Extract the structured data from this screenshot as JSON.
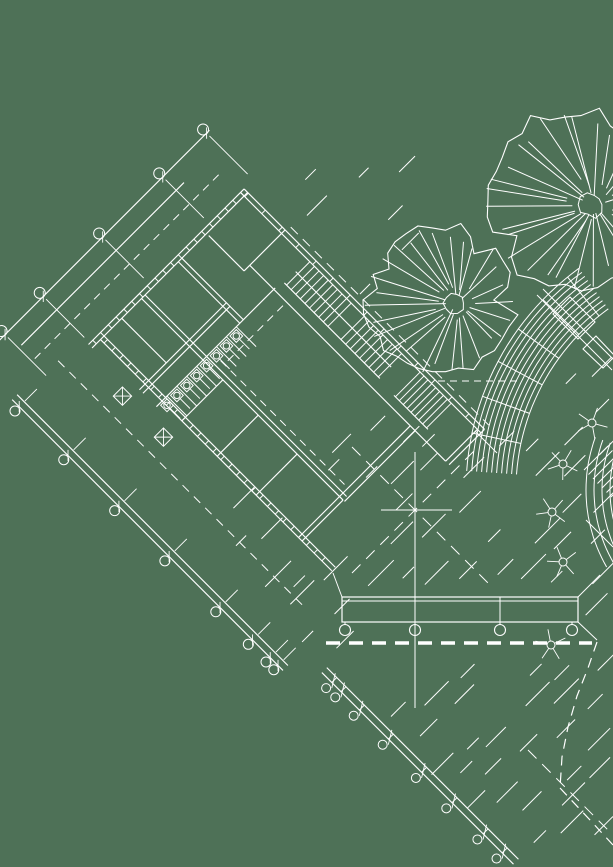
{
  "canvas": {
    "width": 613,
    "height": 867,
    "background": "#4e7157",
    "line_color": "#ffffff"
  },
  "drawing": {
    "building": {
      "origin": [
        97,
        336
      ],
      "rotation_deg": -45,
      "lines": [
        [
          -12,
          0,
          208,
          0
        ],
        [
          -12,
          5,
          208,
          5
        ],
        [
          203,
          0,
          203,
          340
        ],
        [
          208,
          0,
          208,
          340
        ],
        [
          158,
          335,
          203,
          335
        ],
        [
          158,
          340,
          208,
          340
        ],
        [
          158,
          58,
          158,
          335
        ],
        [
          150,
          58,
          208,
          58
        ],
        [
          150,
          8,
          150,
          58
        ],
        [
          -8,
          68,
          115,
          68
        ],
        [
          -8,
          73,
          115,
          73
        ],
        [
          30,
          5,
          30,
          68
        ],
        [
          58,
          5,
          58,
          290
        ],
        [
          63,
          5,
          63,
          290
        ],
        [
          110,
          5,
          110,
          92
        ],
        [
          115,
          5,
          115,
          92
        ],
        [
          -8,
          92,
          160,
          92
        ],
        [
          0,
          5,
          0,
          332
        ],
        [
          5,
          5,
          5,
          332
        ],
        [
          0,
          120,
          58,
          120
        ],
        [
          0,
          170,
          58,
          170
        ],
        [
          0,
          225,
          58,
          225
        ],
        [
          0,
          285,
          58,
          285
        ],
        [
          0,
          290,
          58,
          290
        ],
        [
          58,
          285,
          158,
          285
        ],
        [
          58,
          292,
          158,
          292
        ],
        [
          170,
          95,
          170,
          230
        ],
        [
          168,
          252,
          168,
          300
        ],
        [
          -75,
          -66,
          225,
          -66
        ],
        [
          -60,
          -47,
          170,
          -47
        ],
        [
          -105,
          -15,
          -105,
          368
        ],
        [
          -98,
          -15,
          -98,
          368
        ],
        [
          -79,
          397,
          -79,
          668
        ],
        [
          -72,
          397,
          -72,
          668
        ],
        [
          186,
          95,
          186,
          230
        ]
      ],
      "dashed": [
        [
          214,
          60,
          214,
          340,
          "10 7"
        ],
        [
          -45,
          -10,
          -45,
          340,
          "9 7"
        ],
        [
          -60,
          -28,
          205,
          -28,
          "8 6"
        ],
        [
          70,
          105,
          70,
          280,
          "8 6"
        ],
        [
          75,
          110,
          155,
          110,
          "8 6"
        ]
      ],
      "tick_runs": [
        {
          "axis": "x",
          "from": -6,
          "to": 204,
          "step": 11,
          "a": 0,
          "b": 5
        },
        {
          "axis": "y",
          "from": 10,
          "to": 328,
          "step": 11,
          "a": 0,
          "b": 5
        },
        {
          "axis": "y",
          "from": 6,
          "to": 336,
          "step": 24,
          "a": 203,
          "b": 208
        }
      ],
      "tread_runs": [
        {
          "from": 98,
          "to": 157,
          "step": 6.5,
          "a": 170,
          "b": 203
        },
        {
          "from": 175,
          "to": 228,
          "step": 6.6,
          "a": 170,
          "b": 203
        },
        {
          "from": 254,
          "to": 298,
          "step": 5.5,
          "a": 168,
          "b": 203
        }
      ],
      "dim_bubbles": {
        "xs": [
          -64,
          -10,
          74,
          159,
          221
        ],
        "line_y": -66,
        "circle_y": -71,
        "r": 5.5,
        "ext_y1": -62,
        "ext_y2": -8
      },
      "grid_bubbles": {
        "ys": [
          -5,
          64,
          136,
          207,
          279,
          325,
          350,
          361
        ],
        "cx": -111,
        "r": 5,
        "line_x": -105,
        "ext_x": -80
      },
      "fence_circles": {
        "ys": [
          411,
          424,
          450,
          491,
          538,
          581,
          625,
          652
        ],
        "cx": -87,
        "r": 4.5,
        "x1": -79,
        "x2": -72
      },
      "fixtures": {
        "x0": -4,
        "dx": 14,
        "count": 8,
        "y": 94,
        "size": 9,
        "divider_len": 26
      },
      "planters": [
        {
          "x": -31,
          "y": 54,
          "s": 13
        },
        {
          "x": -31,
          "y": 112,
          "s": 13
        }
      ]
    },
    "trees": [
      {
        "cx": 439,
        "cy": 300,
        "r": 76,
        "seed": 7,
        "spokes": 27
      },
      {
        "cx": 573,
        "cy": 201,
        "r": 91,
        "seed": 13,
        "spokes": 29
      }
    ],
    "shrubs": [
      {
        "cx": 592,
        "cy": 423
      },
      {
        "cx": 563,
        "cy": 464
      },
      {
        "cx": 552,
        "cy": 512
      },
      {
        "cx": 563,
        "cy": 562
      },
      {
        "cx": 551,
        "cy": 645
      }
    ],
    "arc_bands": [
      {
        "cx": 740,
        "cy": 490,
        "r0": 224,
        "r1": 274,
        "count": 11,
        "a0": 184,
        "a1": 235,
        "radials": [
          192,
          200,
          208,
          216,
          224,
          231
        ]
      },
      {
        "cx": 740,
        "cy": 490,
        "r0": 130,
        "r1": 154,
        "count": 4,
        "a0": 150,
        "a1": 200,
        "radials": []
      }
    ],
    "screen_lines": [
      [
        333,
        573,
        342,
        597
      ],
      [
        578,
        597,
        600,
        575
      ],
      [
        578,
        622,
        597,
        640
      ],
      [
        537,
        295,
        612,
        370
      ],
      [
        543,
        289,
        613,
        359
      ],
      [
        586,
        520,
        613,
        547
      ],
      [
        475,
        431,
        497,
        453
      ],
      [
        415,
        452,
        415,
        708
      ],
      [
        381,
        510,
        452,
        510
      ],
      [
        415,
        597,
        415,
        622
      ],
      [
        500,
        597,
        500,
        622
      ]
    ],
    "screen_dashed": [
      [
        352,
        447,
        492,
        587,
        "12 8"
      ],
      [
        352,
        573,
        478,
        447,
        "12 8"
      ],
      [
        438,
        381,
        522,
        381,
        "7 5"
      ],
      [
        528,
        750,
        612,
        834,
        "12 8"
      ]
    ],
    "dashed_polylines": [
      {
        "pts": [
          [
            597,
            642
          ],
          [
            588,
            668
          ],
          [
            577,
            696
          ],
          [
            568,
            727
          ],
          [
            562,
            757
          ],
          [
            560,
            788
          ]
        ],
        "dash": "10 7"
      },
      {
        "pts": [
          [
            560,
            788
          ],
          [
            590,
            820
          ],
          [
            613,
            845
          ]
        ],
        "dash": "10 7"
      }
    ],
    "pergola": {
      "rect": [
        342,
        597,
        578,
        622
      ],
      "inner_top": [
        342,
        601,
        578,
        601
      ],
      "columns_x": [
        345,
        415,
        500,
        572
      ],
      "columns_y": 630,
      "col_r": 5.5,
      "heavy_dash": [
        326,
        643,
        592,
        643
      ],
      "heavy_width": 3.5,
      "heavy_pattern": "14 9"
    },
    "rot_rects": [
      [
        [
          595,
          322
        ],
        [
          578,
          339
        ],
        [
          553,
          314
        ],
        [
          570,
          297
        ]
      ],
      [
        [
          615,
          356
        ],
        [
          603,
          368
        ],
        [
          583,
          349
        ],
        [
          596,
          336
        ]
      ]
    ],
    "edge_treads": {
      "x0": 584,
      "y0": 470,
      "n": 9,
      "step": 4.5,
      "len": 24
    },
    "hatch_patches": [
      {
        "zone": "main",
        "x0": 230,
        "x1": 616,
        "y0": 380,
        "y1": 860,
        "step": 33,
        "jit": 18,
        "lmin": 10,
        "lmax": 26,
        "density": 0.8,
        "seed": 3
      },
      {
        "zone": "ne",
        "x0": 272,
        "x1": 430,
        "y0": 175,
        "y1": 345,
        "step": 41,
        "jit": 16,
        "lmin": 8,
        "lmax": 20,
        "density": 0.55,
        "seed": 5
      },
      {
        "zone": "court",
        "x0": 255,
        "x1": 405,
        "y0": 430,
        "y1": 575,
        "step": 38,
        "jit": 14,
        "lmin": 8,
        "lmax": 18,
        "density": 0.6,
        "seed": 9
      }
    ]
  }
}
